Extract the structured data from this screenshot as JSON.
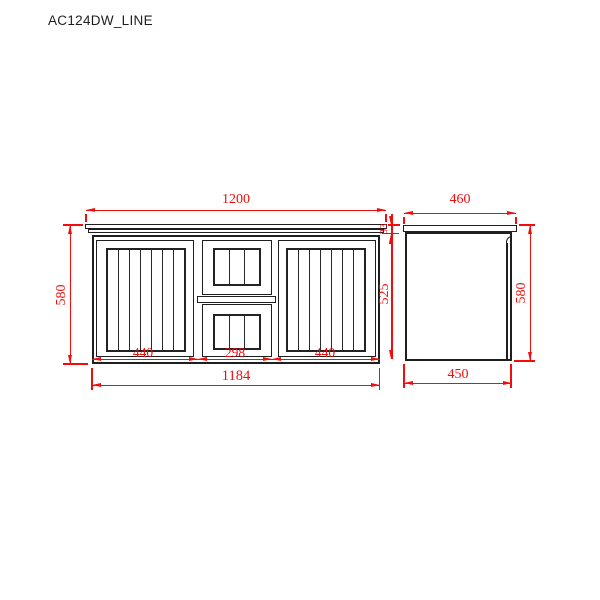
{
  "title": "AC124DW_LINE",
  "colors": {
    "dimension": "#f20d0d",
    "outline": "#1f1f1f",
    "background": "#ffffff"
  },
  "front_view": {
    "dims": {
      "overall_width": "1200",
      "overall_height": "580",
      "benchtop_thickness": "33",
      "left_door_width": "440",
      "drawer_bank_width": "298",
      "right_door_width": "440",
      "cabinet_width": "1184",
      "door_height": "525"
    }
  },
  "side_view": {
    "dims": {
      "overall_depth": "460",
      "overall_height": "580",
      "cabinet_depth": "450"
    }
  }
}
